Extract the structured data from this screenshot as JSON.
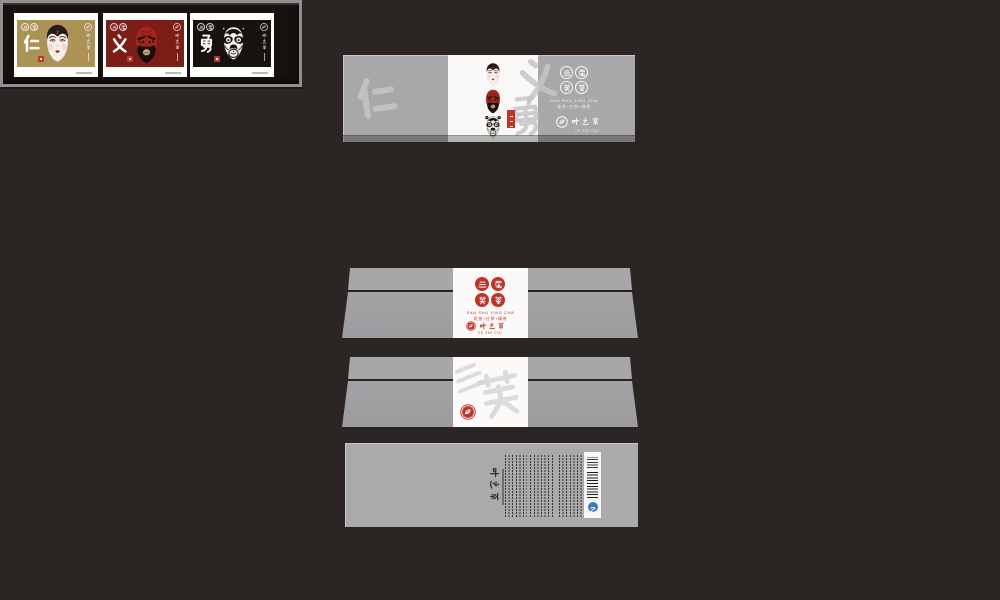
{
  "window": {
    "background": "#2b2523",
    "description_visible": "tea packaging design mockup, five stacked package views"
  },
  "brand": {
    "seal_grid_chars": [
      "三",
      "蜀",
      "英",
      "茶"
    ],
    "seal_grid_join": "三蜀英茶",
    "name_latin": "SAN SHU YING CHA",
    "tea_types_line": "花茶+红茶+绿茶",
    "logo_name": "叶之萃",
    "logo_sub_latin": "YE ZHI CUI",
    "virtues_join": "仁义勇",
    "side_watermark": "三英"
  },
  "palette": {
    "panel_gray": "#a8a8ab",
    "paper_white": "#f9f8f6",
    "seal_red": "#c13327",
    "band_gold": "#ac9255",
    "band_red": "#7c1d18",
    "band_black": "#17120f",
    "tray_black": "#15110e",
    "qs_blue": "#3a7abf"
  },
  "tray": {
    "cards": [
      {
        "virtue": "仁",
        "mask": "dan-white-face-mask",
        "band_color": "#ac9255"
      },
      {
        "virtue": "义",
        "mask": "guan-red-face-mask",
        "band_color": "#7c1d18"
      },
      {
        "virtue": "勇",
        "mask": "zhang-black-white-face-mask",
        "band_color": "#17120f"
      }
    ]
  },
  "lid": {
    "mask_stack": [
      "dan",
      "guan",
      "zhang"
    ],
    "watermark_chars": [
      "仁",
      "义",
      "勇"
    ]
  },
  "base": {
    "rotated_logo": "叶之萃",
    "barcode_present": true,
    "qs_mark": true
  }
}
